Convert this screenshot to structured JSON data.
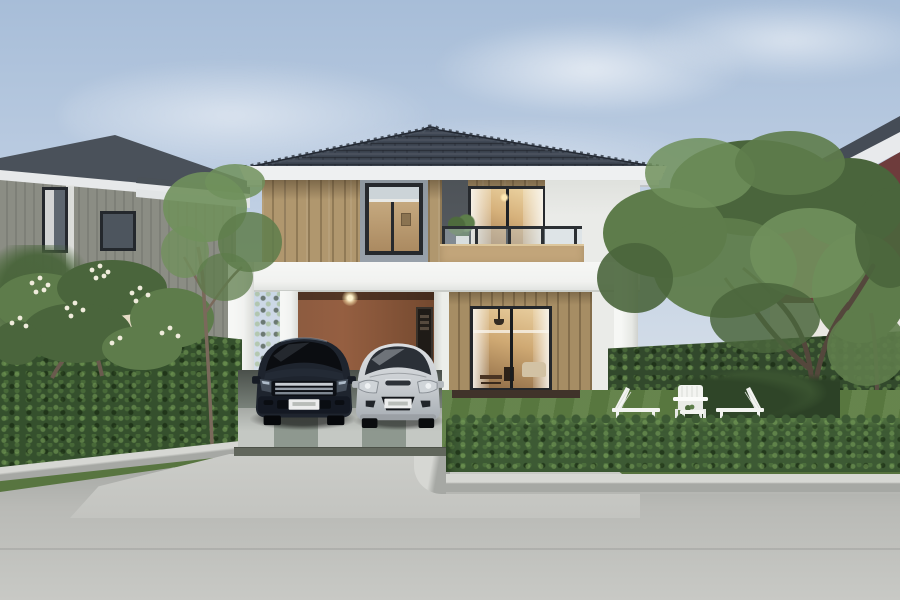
{
  "meta": {
    "type": "photograph",
    "description": "Two-storey modern detached house at dusk with white carport frame, two parked hatchback cars, balcony, warm interior lighting, trimmed hedges, lawn with three white garden chairs, frangipani tree, neighbouring houses and a concrete road in the foreground.",
    "width_px": 900,
    "height_px": 600
  },
  "scene": {
    "objects": [
      "sky with soft clouds",
      "left neighbour house (grey siding, dark hip roof)",
      "right neighbour house (maroon upper wall, white lower wall)",
      "main house hip roof with dark grey tiles and white fascia",
      "upper floor: tan vertical siding, framed window, balcony glass railing, tan parapet, potted plant, lit sliding door",
      "white rectangular carport frame with columns",
      "carport interior: terracotta wall, ceiling light, small dark window",
      "ground floor lit sliding glass door with curtains, sofa and dining furniture",
      "dark navy hatchback car with chrome grille",
      "silver hatchback car",
      "checkered carport tile floor",
      "doormat",
      "frangipani tree with white flowers",
      "slender tree",
      "large green trees on the right",
      "tall trimmed hedges left and right",
      "low rectangular front hedge",
      "lawn with two white loungers, an adirondack chair and a small table",
      "grass verge, concrete curb and road"
    ],
    "cars": [
      {
        "position": "left",
        "color_name": "dark navy",
        "license_plate": "white, text illegible"
      },
      {
        "position": "right",
        "color_name": "silver",
        "license_plate": "white, text illegible"
      }
    ],
    "chairs_count": 3,
    "lighting": "dusk, warm interior lights on"
  },
  "palette": {
    "sky_top": "#a7bdd8",
    "sky_mid": "#c3d2e5",
    "sky_low": "#dde3e9",
    "roof_dark": "#3f4754",
    "roof_ridge": "#49525e",
    "fascia_white": "#eef0f1",
    "wall_tan": "#b0976e",
    "wall_gray": "#99a2ab",
    "wall_dark": "#575c62",
    "wall_white": "#eaebe8",
    "frame_white": "#f1f2f0",
    "frame_dark": "#26292d",
    "carport_wall": "#955f41",
    "parapet_tan": "#c2a57a",
    "left_house_wall": "#8b8d84",
    "left_house_roof": "#4a515a",
    "right_house_wall": "#6e3c3c",
    "tree_green_1": "#5e7c4b",
    "tree_green_2": "#4a653c",
    "tree_green_3": "#70905c",
    "hedge_dark": "#35502d",
    "hedge_mid": "#42613a",
    "lawn_green": "#5d7d42",
    "grass_strip": "#587540",
    "flower_white": "#f0ecdc",
    "trunk_brown": "#54473c",
    "tile_light": "#c4c8c3",
    "tile_dark": "#8e988f",
    "tile_edge": "#61665c",
    "road_light": "#c8c9c5",
    "curb_top": "#d6d7d3",
    "curb_face": "#a6a8a4",
    "car1_body": "#1e242e",
    "car1_glass": "#0b0d11",
    "car2_body": "#c9cdd1",
    "car2_glass": "#2b3037",
    "chrome": "#c7ccd2",
    "plate": "#eceded",
    "chair_white": "#f3f4f1",
    "mat_brown": "#40332a",
    "light_glow": "#ffe9b4"
  }
}
